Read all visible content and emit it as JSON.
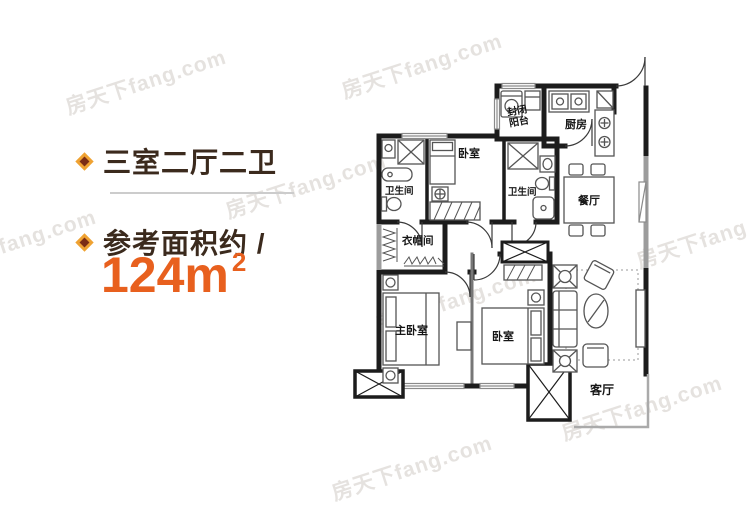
{
  "header": {
    "feature_title": "三室二厅二卫",
    "area_label": "参考面积约 /",
    "area_value": "124m",
    "area_superscript": "2"
  },
  "colors": {
    "accent_orange": "#e8601e",
    "title_brown": "#3b2a1d",
    "bullet_outer": "#efa232",
    "bullet_inner": "#7b2c15",
    "divider_gray": "#cccccc",
    "wall_black": "#1c1c1c",
    "wall_window_gray": "#9c9c9c",
    "furniture_gray": "#555555"
  },
  "floorplan": {
    "rooms": [
      {
        "id": "enclosed-balcony",
        "label": "封闭阳台",
        "label_line1": "封闭",
        "label_line2": "阳台"
      },
      {
        "id": "kitchen",
        "label": "厨房"
      },
      {
        "id": "bathroom-1",
        "label": "卫生间"
      },
      {
        "id": "bedroom-top",
        "label": "卧室"
      },
      {
        "id": "bathroom-2",
        "label": "卫生间"
      },
      {
        "id": "dining-room",
        "label": "餐厅"
      },
      {
        "id": "cloakroom",
        "label": "衣帽间"
      },
      {
        "id": "master-bedroom",
        "label": "主卧室"
      },
      {
        "id": "bedroom-2",
        "label": "卧室"
      },
      {
        "id": "living-room",
        "label": "客厅"
      }
    ]
  },
  "watermark": {
    "text": "房天下fang.com"
  }
}
